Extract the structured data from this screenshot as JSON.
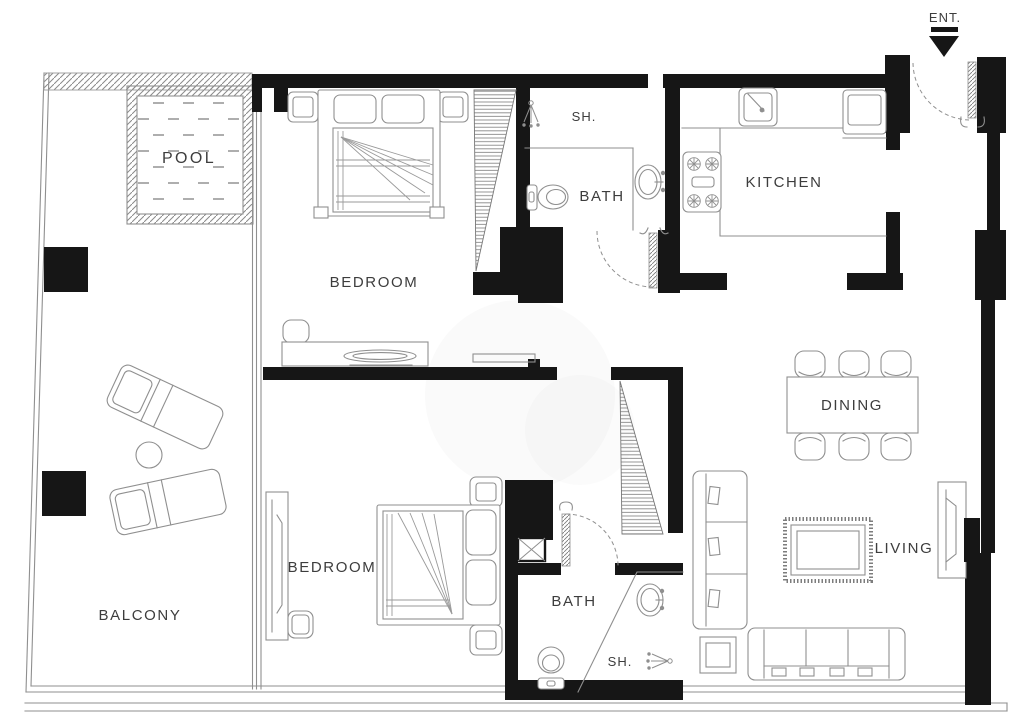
{
  "floor_plan": {
    "labels": {
      "entrance": "ENT.",
      "pool": "POOL",
      "balcony": "BALCONY",
      "bedroom_top": "BEDROOM",
      "shower_top": "SH.",
      "bath_top": "BATH",
      "kitchen": "KITCHEN",
      "dining": "DINING",
      "living": "LIVING",
      "bedroom_bottom": "BEDROOM",
      "bath_bottom": "BATH",
      "shower_bottom": "SH."
    },
    "colors": {
      "wall": "#161616",
      "furniture_line": "#8f8f8f",
      "text": "#3d3d3d",
      "background": "#ffffff"
    }
  }
}
